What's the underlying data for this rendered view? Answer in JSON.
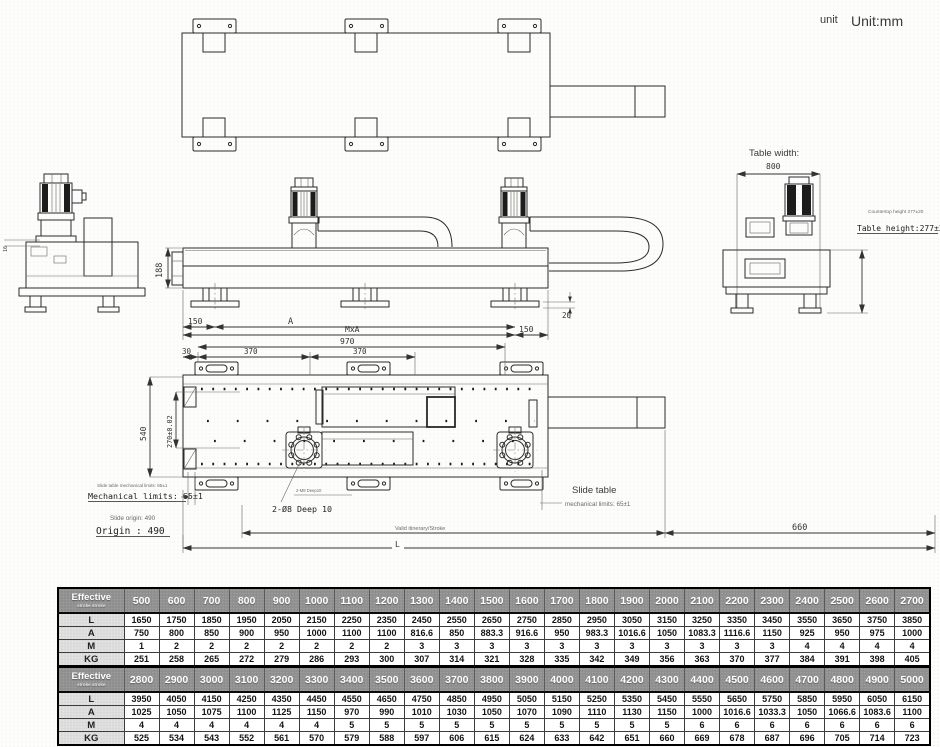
{
  "unit": {
    "small": "unit",
    "large": "Unit:mm"
  },
  "annotations": {
    "table_width_title": "Table width:",
    "table_width_value": "800",
    "countertop_height": "Countertop height 277±20",
    "table_height": "Table height:277±20",
    "slide_limits_small": "Slide table mechanical limits: 65±1",
    "mech_limits": "Mechanical limits: 65±1",
    "slide_origin_small": "Slide origin: 490",
    "origin": "Origin : 490",
    "slide_table_line1": "Slide table",
    "slide_table_line2": "mechanical limits: 65±1",
    "hole_callout": "2-Ø8 Deep 10",
    "hole_callout_small": "2-M8 Deep10",
    "valid_stroke": "Valid itinerary/Stroke"
  },
  "dims": {
    "d188": "188",
    "d150_left": "150",
    "dA": "A",
    "dMxA": "MxA",
    "d150_right": "150",
    "d20": "20",
    "d970": "970",
    "d30": "30",
    "d370_1": "370",
    "d370_2": "370",
    "d540": "540",
    "d270": "270±0.02",
    "d16": "16",
    "d660": "660",
    "dL": "L"
  },
  "tables": [
    {
      "corner_main": "Effective",
      "corner_sub": "stroke stroke",
      "columns": [
        "500",
        "600",
        "700",
        "800",
        "900",
        "1000",
        "1100",
        "1200",
        "1300",
        "1400",
        "1500",
        "1600",
        "1700",
        "1800",
        "1900",
        "2000",
        "2100",
        "2200",
        "2300",
        "2400",
        "2500",
        "2600",
        "2700"
      ],
      "rows": [
        {
          "label": "L",
          "values": [
            "1650",
            "1750",
            "1850",
            "1950",
            "2050",
            "2150",
            "2250",
            "2350",
            "2450",
            "2550",
            "2650",
            "2750",
            "2850",
            "2950",
            "3050",
            "3150",
            "3250",
            "3350",
            "3450",
            "3550",
            "3650",
            "3750",
            "3850"
          ]
        },
        {
          "label": "A",
          "values": [
            "750",
            "800",
            "850",
            "900",
            "950",
            "1000",
            "1100",
            "1100",
            "816.6",
            "850",
            "883.3",
            "916.6",
            "950",
            "983.3",
            "1016.6",
            "1050",
            "1083.3",
            "1116.6",
            "1150",
            "925",
            "950",
            "975",
            "1000"
          ]
        },
        {
          "label": "M",
          "values": [
            "1",
            "2",
            "2",
            "2",
            "2",
            "2",
            "2",
            "2",
            "3",
            "3",
            "3",
            "3",
            "3",
            "3",
            "3",
            "3",
            "3",
            "3",
            "3",
            "4",
            "4",
            "4",
            "4"
          ]
        },
        {
          "label": "KG",
          "values": [
            "251",
            "258",
            "265",
            "272",
            "279",
            "286",
            "293",
            "300",
            "307",
            "314",
            "321",
            "328",
            "335",
            "342",
            "349",
            "356",
            "363",
            "370",
            "377",
            "384",
            "391",
            "398",
            "405"
          ]
        }
      ]
    },
    {
      "corner_main": "Effective",
      "corner_sub": "stroke stroke",
      "columns": [
        "2800",
        "2900",
        "3000",
        "3100",
        "3200",
        "3300",
        "3400",
        "3500",
        "3600",
        "3700",
        "3800",
        "3900",
        "4000",
        "4100",
        "4200",
        "4300",
        "4400",
        "4500",
        "4600",
        "4700",
        "4800",
        "4900",
        "5000"
      ],
      "rows": [
        {
          "label": "L",
          "values": [
            "3950",
            "4050",
            "4150",
            "4250",
            "4350",
            "4450",
            "4550",
            "4650",
            "4750",
            "4850",
            "4950",
            "5050",
            "5150",
            "5250",
            "5350",
            "5450",
            "5550",
            "5650",
            "5750",
            "5850",
            "5950",
            "6050",
            "6150"
          ]
        },
        {
          "label": "A",
          "values": [
            "1025",
            "1050",
            "1075",
            "1100",
            "1125",
            "1150",
            "970",
            "990",
            "1010",
            "1030",
            "1050",
            "1070",
            "1090",
            "1110",
            "1130",
            "1150",
            "1000",
            "1016.6",
            "1033.3",
            "1050",
            "1066.6",
            "1083.6",
            "1100"
          ]
        },
        {
          "label": "M",
          "values": [
            "4",
            "4",
            "4",
            "4",
            "4",
            "4",
            "5",
            "5",
            "5",
            "5",
            "5",
            "5",
            "5",
            "5",
            "5",
            "5",
            "6",
            "6",
            "6",
            "6",
            "6",
            "6",
            "6"
          ]
        },
        {
          "label": "KG",
          "values": [
            "525",
            "534",
            "543",
            "552",
            "561",
            "570",
            "579",
            "588",
            "597",
            "606",
            "615",
            "624",
            "633",
            "642",
            "651",
            "660",
            "669",
            "678",
            "687",
            "696",
            "705",
            "714",
            "723"
          ]
        }
      ]
    }
  ]
}
